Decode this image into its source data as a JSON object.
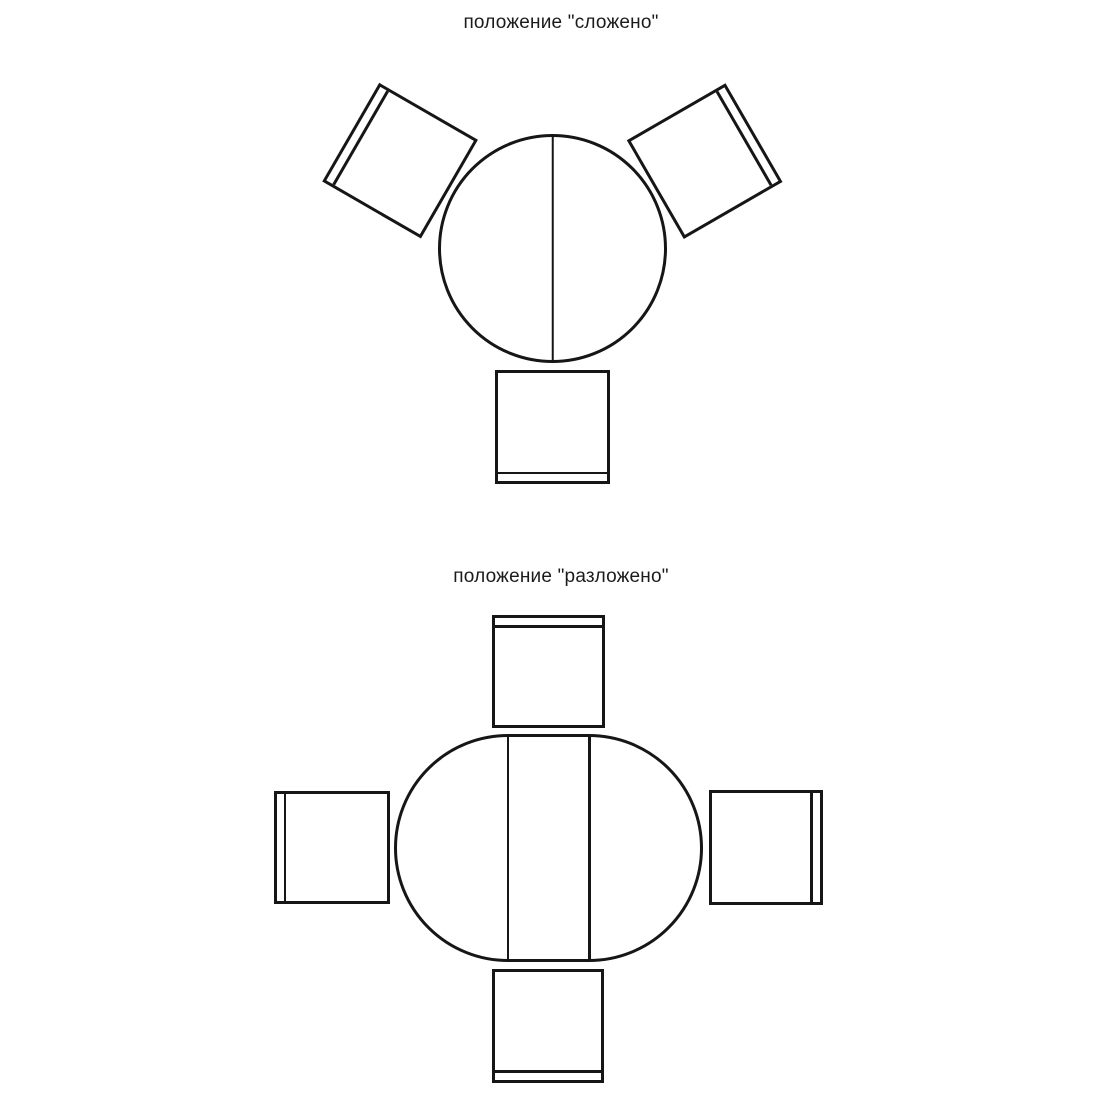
{
  "page": {
    "background_color": "#ffffff",
    "line_color": "#161616"
  },
  "figures": [
    {
      "caption": "положение \"сложено\"",
      "fold_state": "folded",
      "table_shape": "round-with-fold-line",
      "chair_count": 3,
      "chair_positions": [
        "top-left-angled",
        "top-right-angled",
        "bottom"
      ]
    },
    {
      "caption": "положение \"разложено\"",
      "fold_state": "unfolded",
      "table_shape": "oval-extended-with-center-leaf",
      "chair_count": 4,
      "chair_positions": [
        "top",
        "left",
        "right",
        "bottom"
      ]
    }
  ]
}
